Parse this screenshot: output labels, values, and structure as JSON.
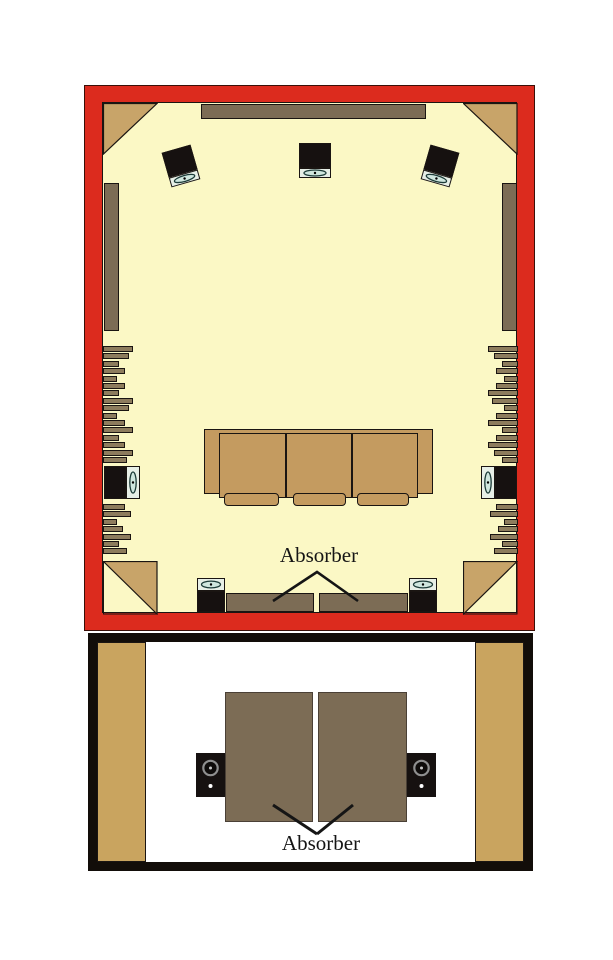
{
  "diagram": {
    "plan_view": {
      "absorber_label": "Absorber"
    },
    "front_view": {
      "absorber_label": "Absorber"
    }
  },
  "colors": {
    "wall_red": "#DC2B1E",
    "floor_cream": "#FBF8C5",
    "panel_brown": "#7C6C55",
    "strip_brown": "#8D7C5D",
    "trap_tan": "#C8A469",
    "sofa_tan": "#C49B60",
    "column_tan": "#C9A45F",
    "outline_dark": "#1A1512",
    "speaker_black": "#161110",
    "baffle_light": "#E7EFE7",
    "driver_stroke": "#1C3B38",
    "driver_fill": "#CFE6DE",
    "view_bg": "#FFFFFF",
    "frame_black": "#120D09"
  },
  "diffusers": {
    "left_upper": [
      30,
      26,
      16,
      22,
      14,
      22,
      16,
      30,
      26,
      14,
      22,
      30,
      16,
      22,
      30,
      24
    ],
    "left_lower": [
      22,
      28,
      14,
      20,
      28,
      16,
      24
    ],
    "right_upper": [
      30,
      24,
      16,
      22,
      14,
      22,
      30,
      26,
      14,
      22,
      30,
      16,
      22,
      30,
      24,
      16
    ],
    "right_lower": [
      22,
      28,
      14,
      20,
      28,
      16,
      24
    ]
  }
}
